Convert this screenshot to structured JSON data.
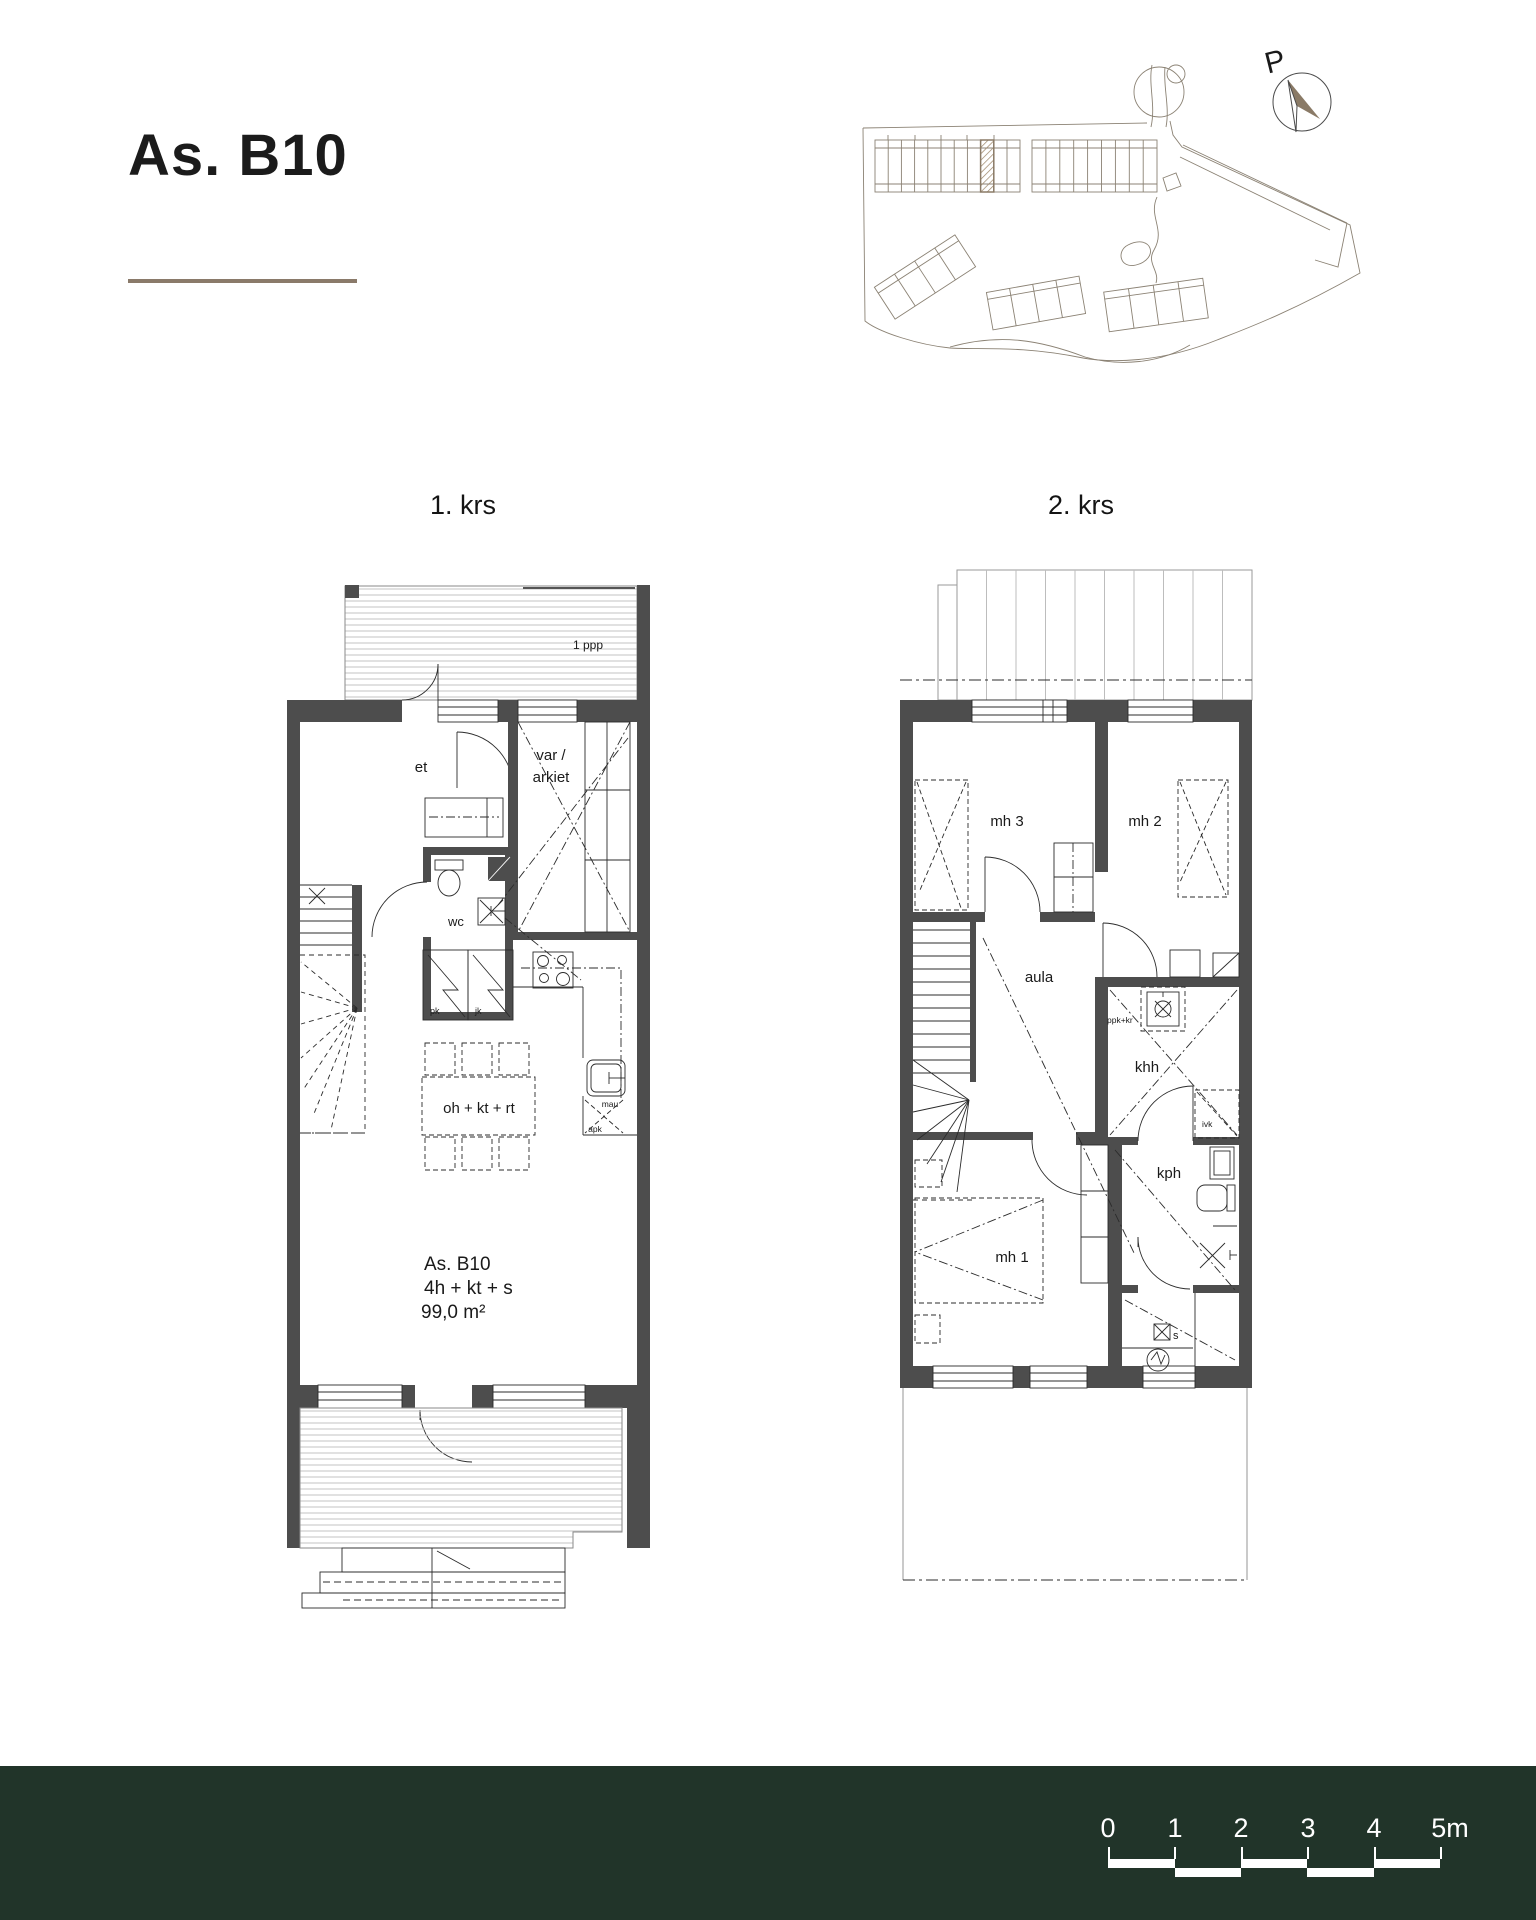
{
  "header": {
    "title": "As. B10"
  },
  "site_plan": {
    "north_label": "P"
  },
  "floor1": {
    "label": "1. krs",
    "deck_label": "1 ppp",
    "rooms": {
      "entry": "et",
      "storage_line1": "var /",
      "storage_line2": "arkiet",
      "wc": "wc",
      "living": "oh + kt + rt"
    },
    "appliances": {
      "pk": "pk",
      "jk": "jk",
      "mau": "mau",
      "apk": "apk"
    },
    "apartment": {
      "id": "As. B10",
      "layout": "4h + kt + s",
      "area": "99,0 m²"
    }
  },
  "floor2": {
    "label": "2. krs",
    "rooms": {
      "bedroom3": "mh 3",
      "bedroom2": "mh 2",
      "hall": "aula",
      "utility": "khh",
      "bathroom": "kph",
      "bedroom1": "mh 1",
      "sauna": "s"
    },
    "annotations": {
      "ppk_kr": "ppk+kr",
      "ivk": "ivk"
    }
  },
  "scale_bar": {
    "ticks": [
      "0",
      "1",
      "2",
      "3",
      "4",
      "5m"
    ]
  },
  "colors": {
    "wall_gray": "#4d4d4d",
    "accent_brown": "#8a7a66",
    "footer_green": "#213429",
    "plan_line": "#2b2b2b",
    "site_line": "#8b8274"
  }
}
